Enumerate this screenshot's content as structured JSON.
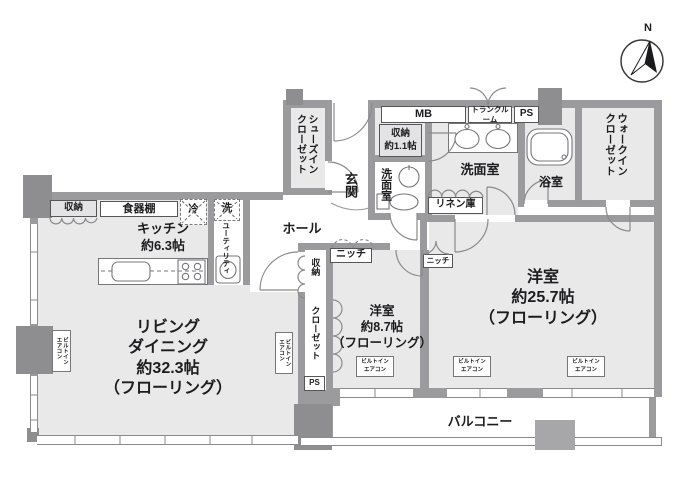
{
  "compass": {
    "north_label": "N"
  },
  "rooms": {
    "living": {
      "line1": "リビング",
      "line2": "ダイニング",
      "line3": "約32.3帖",
      "line4": "（フローリング）"
    },
    "kitchen": {
      "line1": "キッチン",
      "line2": "約6.3帖"
    },
    "bedroom_main": {
      "line1": "洋室",
      "line2": "約25.7帖",
      "line3": "（フローリング）"
    },
    "bedroom_sub": {
      "line1": "洋室",
      "line2": "約8.7帖",
      "line3": "（フローリング）"
    },
    "balcony": {
      "label": "バルコニー"
    },
    "hall": {
      "label": "ホール"
    },
    "entrance": {
      "label": "玄関"
    },
    "shoes_in_closet": {
      "line1": "シューズイン",
      "line2": "クローゼット"
    },
    "walk_in_closet": {
      "line1": "ウォークイン",
      "line2": "クローゼット"
    },
    "washroom": {
      "label": "洗面室"
    },
    "toilet_room": {
      "label": "洗面室"
    },
    "bathroom": {
      "label": "浴室"
    },
    "storage_1_1": {
      "line1": "収納",
      "line2": "約1.1帖"
    },
    "utility": {
      "label": "ユーティリティ"
    }
  },
  "features": {
    "linen_closet": "リネン庫",
    "cupboard": "食器棚",
    "kitchen_storage": "収納",
    "fridge": "冷",
    "washer": "洗",
    "meter_box": "MB",
    "trunk_room": "トランクルーム",
    "pipe_space_top": "PS",
    "pipe_space_side": "PS",
    "strip_storage": "収納",
    "strip_closet": "クローゼット",
    "niche_hall": "ニッチ",
    "niche_bedroom": "ニッチ",
    "aircon_line1": "ビルトイン",
    "aircon_line2": "エアコン"
  },
  "colors": {
    "wall": "#9b9b9d",
    "column": "#8e8e90",
    "room_fill": "#e9e9ea",
    "fixture_line": "#8a8a8c"
  }
}
